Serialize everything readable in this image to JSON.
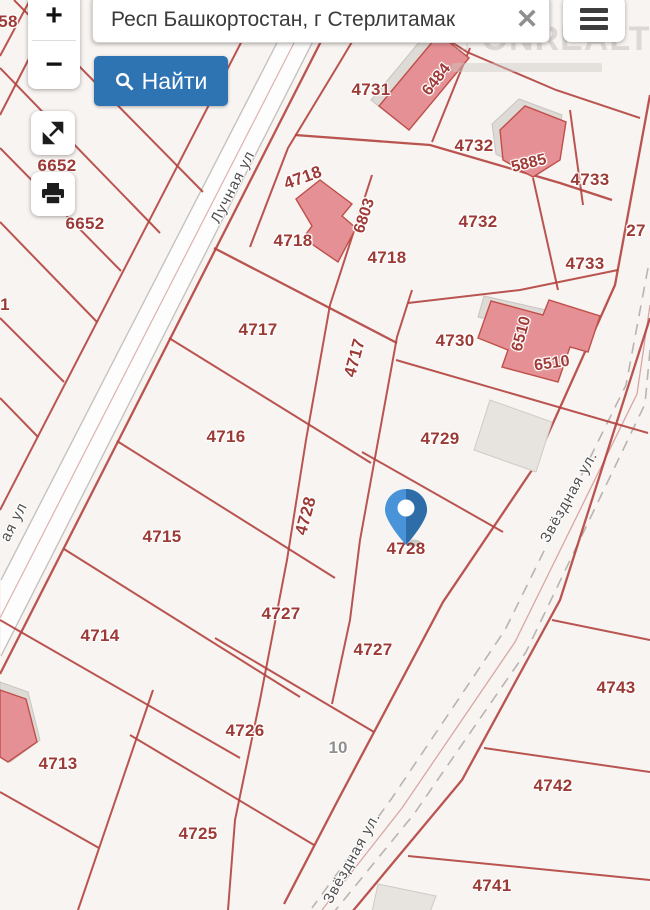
{
  "ui": {
    "search": {
      "value": "Респ Башкортостан, г Стерлитамак",
      "clear_glyph": "✕"
    },
    "buttons": {
      "zoom_in": "+",
      "zoom_out": "−",
      "find": "Найти"
    },
    "watermark": "ONREALT",
    "colors": {
      "accent_blue": "#2e73b2",
      "parcel_line": "#b2423e",
      "label_red": "#9c3a36",
      "building_fill": "#e59094",
      "pin_blue": "#3d7fc1"
    }
  },
  "map": {
    "pin": {
      "parcel": "4728"
    },
    "streets": [
      "Лучная ул",
      "Звёздная ул."
    ],
    "labels": [
      {
        "t": "58",
        "x": 8,
        "y": 22,
        "r": 0,
        "c": "parcel"
      },
      {
        "t": "6652",
        "x": 57,
        "y": 166,
        "r": 0,
        "c": "parcel"
      },
      {
        "t": "6652",
        "x": 85,
        "y": 224,
        "r": 0,
        "c": "parcel"
      },
      {
        "t": "1",
        "x": 5,
        "y": 305,
        "r": 0,
        "c": "parcel"
      },
      {
        "t": "4731",
        "x": 371,
        "y": 90,
        "r": 0,
        "c": "parcel"
      },
      {
        "t": "6484",
        "x": 437,
        "y": 80,
        "r": -52,
        "c": "bldg"
      },
      {
        "t": "4732",
        "x": 474,
        "y": 146,
        "r": 0,
        "c": "parcel"
      },
      {
        "t": "5885",
        "x": 529,
        "y": 164,
        "r": -14,
        "c": "bldg"
      },
      {
        "t": "4733",
        "x": 590,
        "y": 180,
        "r": 0,
        "c": "parcel"
      },
      {
        "t": "4718",
        "x": 303,
        "y": 178,
        "r": -20,
        "c": "parcel"
      },
      {
        "t": "6803",
        "x": 365,
        "y": 216,
        "r": -72,
        "c": "bldg"
      },
      {
        "t": "4732",
        "x": 478,
        "y": 222,
        "r": 0,
        "c": "parcel"
      },
      {
        "t": "27",
        "x": 636,
        "y": 231,
        "r": 0,
        "c": "parcel"
      },
      {
        "t": "4718",
        "x": 293,
        "y": 241,
        "r": 0,
        "c": "parcel"
      },
      {
        "t": "4718",
        "x": 387,
        "y": 258,
        "r": 0,
        "c": "parcel"
      },
      {
        "t": "4733",
        "x": 585,
        "y": 264,
        "r": 0,
        "c": "parcel"
      },
      {
        "t": "4717",
        "x": 258,
        "y": 330,
        "r": 0,
        "c": "parcel"
      },
      {
        "t": "4730",
        "x": 455,
        "y": 341,
        "r": 0,
        "c": "parcel"
      },
      {
        "t": "6510",
        "x": 522,
        "y": 334,
        "r": -75,
        "c": "bldg"
      },
      {
        "t": "4717",
        "x": 355,
        "y": 358,
        "r": -75,
        "c": "parcel"
      },
      {
        "t": "6510",
        "x": 552,
        "y": 364,
        "r": -8,
        "c": "bldg"
      },
      {
        "t": "4716",
        "x": 226,
        "y": 437,
        "r": 0,
        "c": "parcel"
      },
      {
        "t": "4729",
        "x": 440,
        "y": 439,
        "r": 0,
        "c": "parcel"
      },
      {
        "t": "4728",
        "x": 306,
        "y": 516,
        "r": -75,
        "c": "parcel"
      },
      {
        "t": "4715",
        "x": 162,
        "y": 537,
        "r": 0,
        "c": "parcel"
      },
      {
        "t": "4728",
        "x": 406,
        "y": 549,
        "r": 0,
        "c": "parcel"
      },
      {
        "t": "4727",
        "x": 281,
        "y": 614,
        "r": 0,
        "c": "parcel"
      },
      {
        "t": "4714",
        "x": 100,
        "y": 636,
        "r": 0,
        "c": "parcel"
      },
      {
        "t": "4727",
        "x": 373,
        "y": 650,
        "r": 0,
        "c": "parcel"
      },
      {
        "t": "4743",
        "x": 616,
        "y": 688,
        "r": 0,
        "c": "parcel"
      },
      {
        "t": "4726",
        "x": 245,
        "y": 731,
        "r": 0,
        "c": "parcel"
      },
      {
        "t": "10",
        "x": 338,
        "y": 748,
        "r": 0,
        "c": "gray"
      },
      {
        "t": "4713",
        "x": 58,
        "y": 764,
        "r": 0,
        "c": "parcel"
      },
      {
        "t": "4742",
        "x": 553,
        "y": 786,
        "r": 0,
        "c": "parcel"
      },
      {
        "t": "4725",
        "x": 198,
        "y": 834,
        "r": 0,
        "c": "parcel"
      },
      {
        "t": "4741",
        "x": 492,
        "y": 886,
        "r": 0,
        "c": "parcel"
      },
      {
        "t": "Лучная ул",
        "x": 233,
        "y": 187,
        "r": -63,
        "c": "street"
      },
      {
        "t": "ая ул",
        "x": 14,
        "y": 522,
        "r": -63,
        "c": "street"
      },
      {
        "t": "Звёздная ул.",
        "x": 569,
        "y": 497,
        "r": -61,
        "c": "street"
      },
      {
        "t": "Звёздная ул.",
        "x": 352,
        "y": 858,
        "r": -61,
        "c": "street"
      }
    ]
  }
}
